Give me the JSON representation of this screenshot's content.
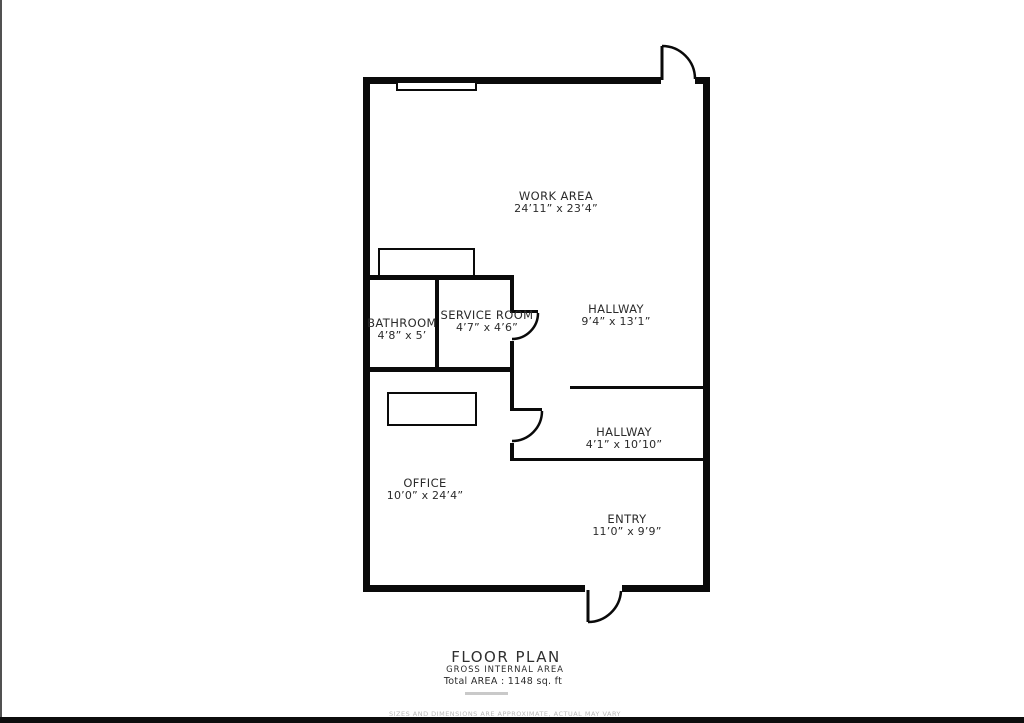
{
  "colors": {
    "wall": "#0a0a0a",
    "text": "#2b2b2b",
    "muted": "#b8b8b8",
    "edge": "#515151",
    "bar": "#0d0d0d",
    "faint": "#c9c9c9"
  },
  "rooms": [
    {
      "id": "work-area",
      "label": "WORK AREA",
      "dims": "24’11” x 23’4”"
    },
    {
      "id": "hallway-upper",
      "label": "HALLWAY",
      "dims": "9’4” x 13’1”"
    },
    {
      "id": "bathroom",
      "label": "BATHROOM",
      "dims": "4’8” x 5’"
    },
    {
      "id": "service-room",
      "label": "SERVICE ROOM",
      "dims": "4’7” x 4’6”"
    },
    {
      "id": "hallway-lower",
      "label": "HALLWAY",
      "dims": "4’1” x 10’10”"
    },
    {
      "id": "office",
      "label": "OFFICE",
      "dims": "10’0” x 24’4”"
    },
    {
      "id": "entry",
      "label": "ENTRY",
      "dims": "11’0” x 9’9”"
    }
  ],
  "footer": {
    "title": "FLOOR PLAN",
    "subtitle": "GROSS INTERNAL AREA",
    "total": "Total AREA : 1148 sq. ft",
    "disclaimer": "SIZES AND DIMENSIONS ARE APPROXIMATE, ACTUAL MAY VARY"
  }
}
